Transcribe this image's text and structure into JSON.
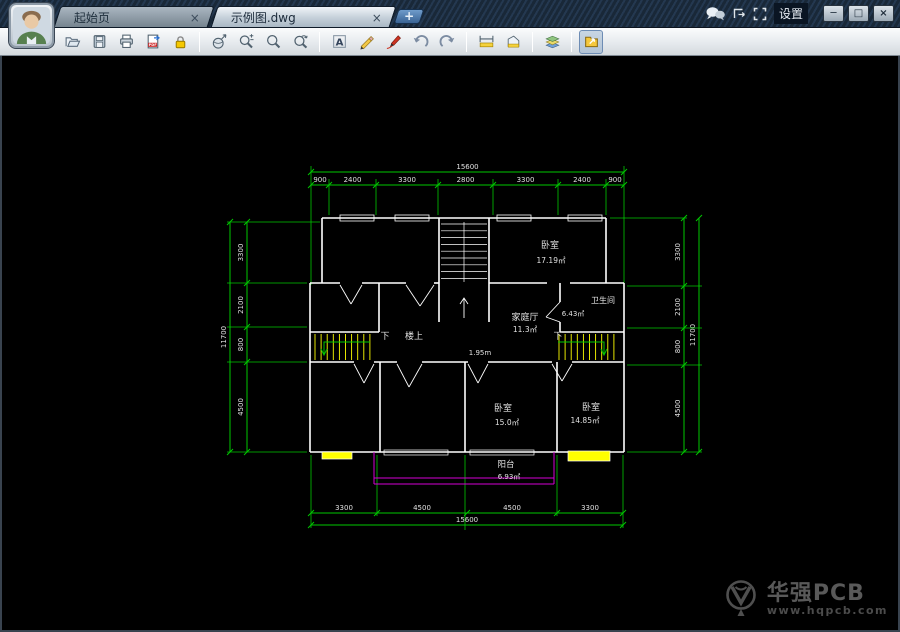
{
  "titlebar": {
    "tabs": [
      {
        "label": "起始页",
        "close": "×"
      },
      {
        "label": "示例图.dwg",
        "close": "×"
      }
    ],
    "new_tab_label": "+",
    "settings_label": "设置",
    "window_controls": {
      "minimize": "─",
      "maximize": "□",
      "close": "×"
    }
  },
  "toolbar": {
    "icons": [
      "open",
      "save",
      "print",
      "export-pdf",
      "lock",
      "zoom-extents",
      "zoom-in-out",
      "zoom-window",
      "zoom-previous",
      "text-annotation",
      "pencil-markup",
      "brush-markup",
      "undo",
      "redo",
      "measure-length",
      "measure-area",
      "layers",
      "open-drawing"
    ]
  },
  "drawing": {
    "dim_top": {
      "overall": "15600",
      "segments": [
        "900",
        "2400",
        "3300",
        "2800",
        "3300",
        "2400",
        "900"
      ]
    },
    "dim_bottom": {
      "overall": "15600",
      "segments": [
        "3300",
        "4500",
        "4500",
        "3300"
      ]
    },
    "dim_left": {
      "overall": "11700",
      "segments": [
        "3300",
        "2100",
        "800",
        "4500"
      ]
    },
    "dim_right": {
      "overall": "11700",
      "segments": [
        "3300",
        "2100",
        "800",
        "4500"
      ]
    },
    "rooms": [
      {
        "name": "卧室",
        "area": "17.19㎡"
      },
      {
        "name": "卫生间",
        "area": "6.43㎡"
      },
      {
        "name": "家庭厅",
        "area": "11.3㎡"
      },
      {
        "name": "卧室",
        "area": "15.0㎡"
      },
      {
        "name": "卧室",
        "area": "14.85㎡"
      },
      {
        "name": "阳台",
        "area": "6.93㎡"
      }
    ],
    "annotations": {
      "down_left": "下",
      "upstairs": "楼上",
      "down_right": "下",
      "width_label": "1.95m"
    },
    "colors": {
      "dimension": "#00c800",
      "wall": "#ffffff",
      "stair": "#ffff00",
      "balcony": "#d400d4",
      "background": "#000000",
      "text": "#e0e0e0"
    }
  },
  "watermark": {
    "brand": "华强PCB",
    "url": "www.hqpcb.com"
  }
}
